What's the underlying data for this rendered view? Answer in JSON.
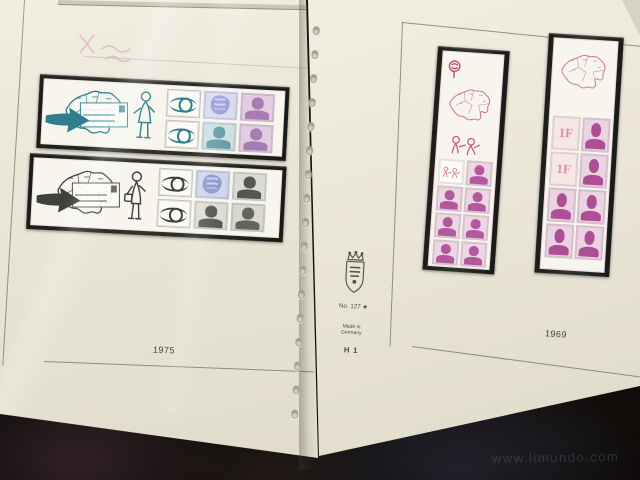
{
  "page_left": {
    "year_label": "1975",
    "booklets": [
      {
        "name": "booklet-1975-teal",
        "cover_art": [
          "belgium-province-map",
          "bold-right-arrow",
          "addressed-envelope",
          "cartoon-lady"
        ],
        "stamps": [
          "posthorn",
          "heraldic-lion",
          "king-baudouin",
          "posthorn",
          "king-baudouin",
          "king-baudouin"
        ]
      },
      {
        "name": "booklet-1975-dark",
        "cover_art": [
          "belgium-province-map",
          "bold-right-arrow",
          "addressed-envelope",
          "cartoon-postman"
        ],
        "stamps": [
          "posthorn",
          "heraldic-lion",
          "king-baudouin",
          "posthorn",
          "king-baudouin",
          "king-baudouin"
        ]
      }
    ]
  },
  "page_right": {
    "year_label": "1969",
    "stamp_value_label": "1F",
    "booklets": [
      {
        "name": "booklet-1969-left",
        "cover_art": [
          "posthorn-badge",
          "belgium-province-map",
          "cartoon-figures"
        ],
        "stamps": [
          "doodle-label",
          "king-baudouin",
          "king-baudouin",
          "king-baudouin",
          "king-baudouin",
          "king-baudouin",
          "king-baudouin",
          "king-baudouin"
        ]
      },
      {
        "name": "booklet-1969-right",
        "cover_art": [
          "belgium-province-map"
        ],
        "stamps": [
          "1F-numeral",
          "king-baudouin",
          "1F-numeral",
          "king-baudouin",
          "king-baudouin",
          "king-baudouin",
          "king-baudouin",
          "king-baudouin"
        ]
      }
    ]
  },
  "binder_margin": {
    "logo_icon": "crown-shield-crest",
    "catalog_no": "No. 127 ★",
    "made_in_line1": "Made in",
    "made_in_line2": "Germany",
    "sheet_code": "H 1",
    "punch_hole_count": 17
  },
  "watermark": {
    "text": "www.limundo.com"
  },
  "icons": {
    "crest": "crown-shield-crest",
    "map": "belgium-province-map",
    "arrow": "bold-right-arrow",
    "posthorn": "posthorn-circle",
    "lion": "heraldic-lion",
    "king": "king-baudouin-portrait"
  },
  "colors": {
    "page_cream": "#e9e5d6",
    "mount_black": "#232321",
    "booklet_white": "#f7f5ee",
    "teal": "#2e7e8e",
    "dark_ink": "#3f3f3c",
    "pink": "#c96a85",
    "magenta": "#b2589d",
    "background_dark": "#16110d"
  }
}
